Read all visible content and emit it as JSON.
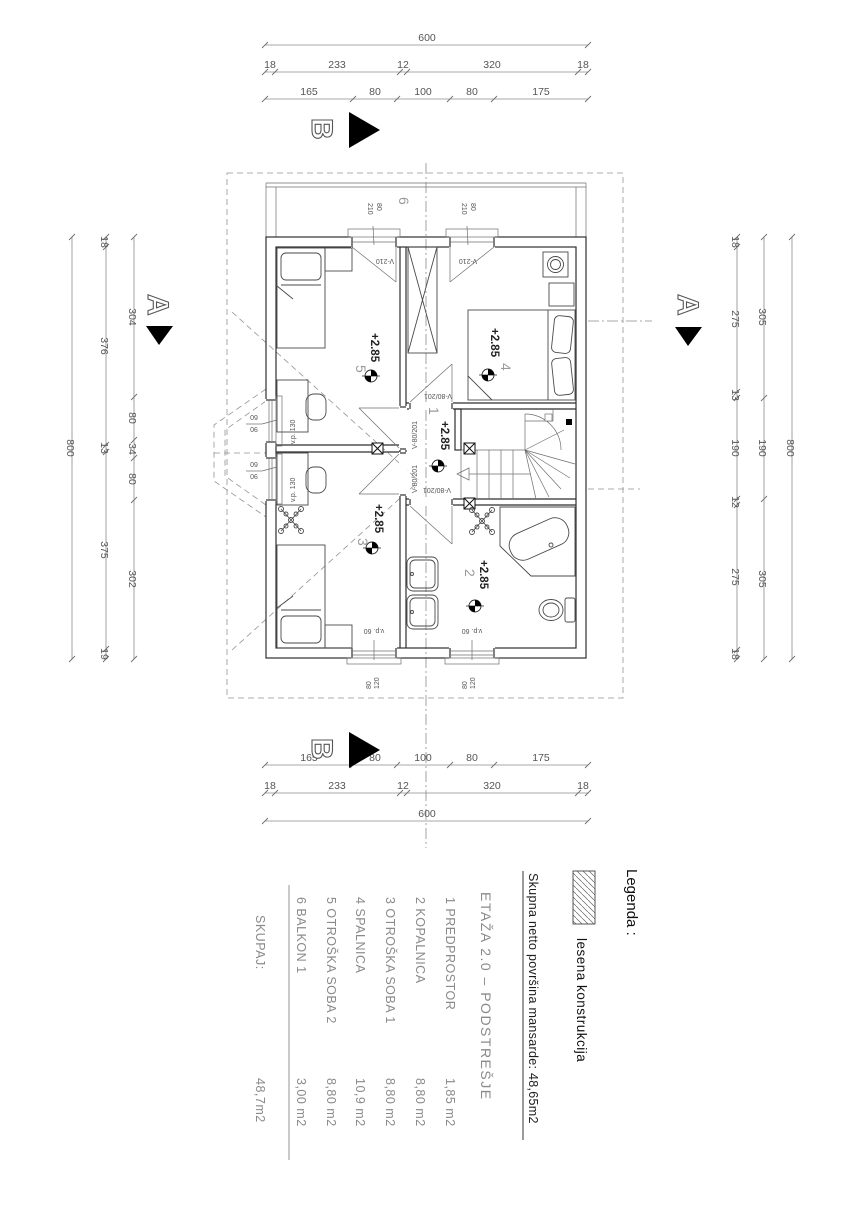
{
  "dims": {
    "top": {
      "total": "600",
      "outer": [
        "18",
        "233",
        "12",
        "320",
        "18"
      ],
      "inner": [
        "165",
        "80",
        "100",
        "80",
        "175"
      ]
    },
    "bottom": {
      "total": "600",
      "outer": [
        "18",
        "233",
        "12",
        "320",
        "18"
      ],
      "inner": [
        "165",
        "80",
        "100",
        "80",
        "175"
      ]
    },
    "left": {
      "total": "800",
      "outer": [
        "18",
        "376",
        "13",
        "375",
        "19"
      ],
      "inner": [
        "304",
        "80",
        "34",
        "80",
        "302"
      ]
    },
    "right": {
      "total": "800",
      "inner": [
        "18",
        "275",
        "13",
        "190",
        "12",
        "275",
        "18"
      ],
      "mid": [
        "305",
        "190",
        "305"
      ]
    }
  },
  "markers": {
    "a": "A",
    "b": "B"
  },
  "plan": {
    "level": "+2.85",
    "rooms": {
      "r1": "1",
      "r2": "2",
      "r3": "3",
      "r4": "4",
      "r5": "5",
      "r6": "6"
    },
    "doors": {
      "balcony_w": "80",
      "balcony_h": "210",
      "balcony_mark": "V-210",
      "interior_mark": "V-80/201"
    },
    "windows": {
      "side_w": "90",
      "side_h": "60",
      "side_parapet": "v.p. 130",
      "bottom_w": "80",
      "bottom_h": "120",
      "bottom_parapet": "v.p. 60"
    }
  },
  "legend": {
    "title": "Legenda :",
    "item": "lesena konstrukcija"
  },
  "summary": {
    "text": "Skupna netto površina  mansarde: 48,65m2"
  },
  "table": {
    "heading": "ETAŽA 2.0  –  PODSTREŠJE",
    "rows": [
      {
        "name": "1 PREDPROSTOR",
        "area": "1,85 m2"
      },
      {
        "name": "2 KOPALNICA",
        "area": "8,80 m2"
      },
      {
        "name": "3 OTROŠKA SOBA 1",
        "area": "8,80 m2"
      },
      {
        "name": "4 SPALNICA",
        "area": "10,9 m2"
      },
      {
        "name": "5 OTROŠKA SOBA 2",
        "area": "8,80 m2"
      },
      {
        "name": "6 BALKON 1",
        "area": "3,00 m2"
      }
    ],
    "total_label": "SKUPAJ:",
    "total_value": "48,7m2"
  }
}
